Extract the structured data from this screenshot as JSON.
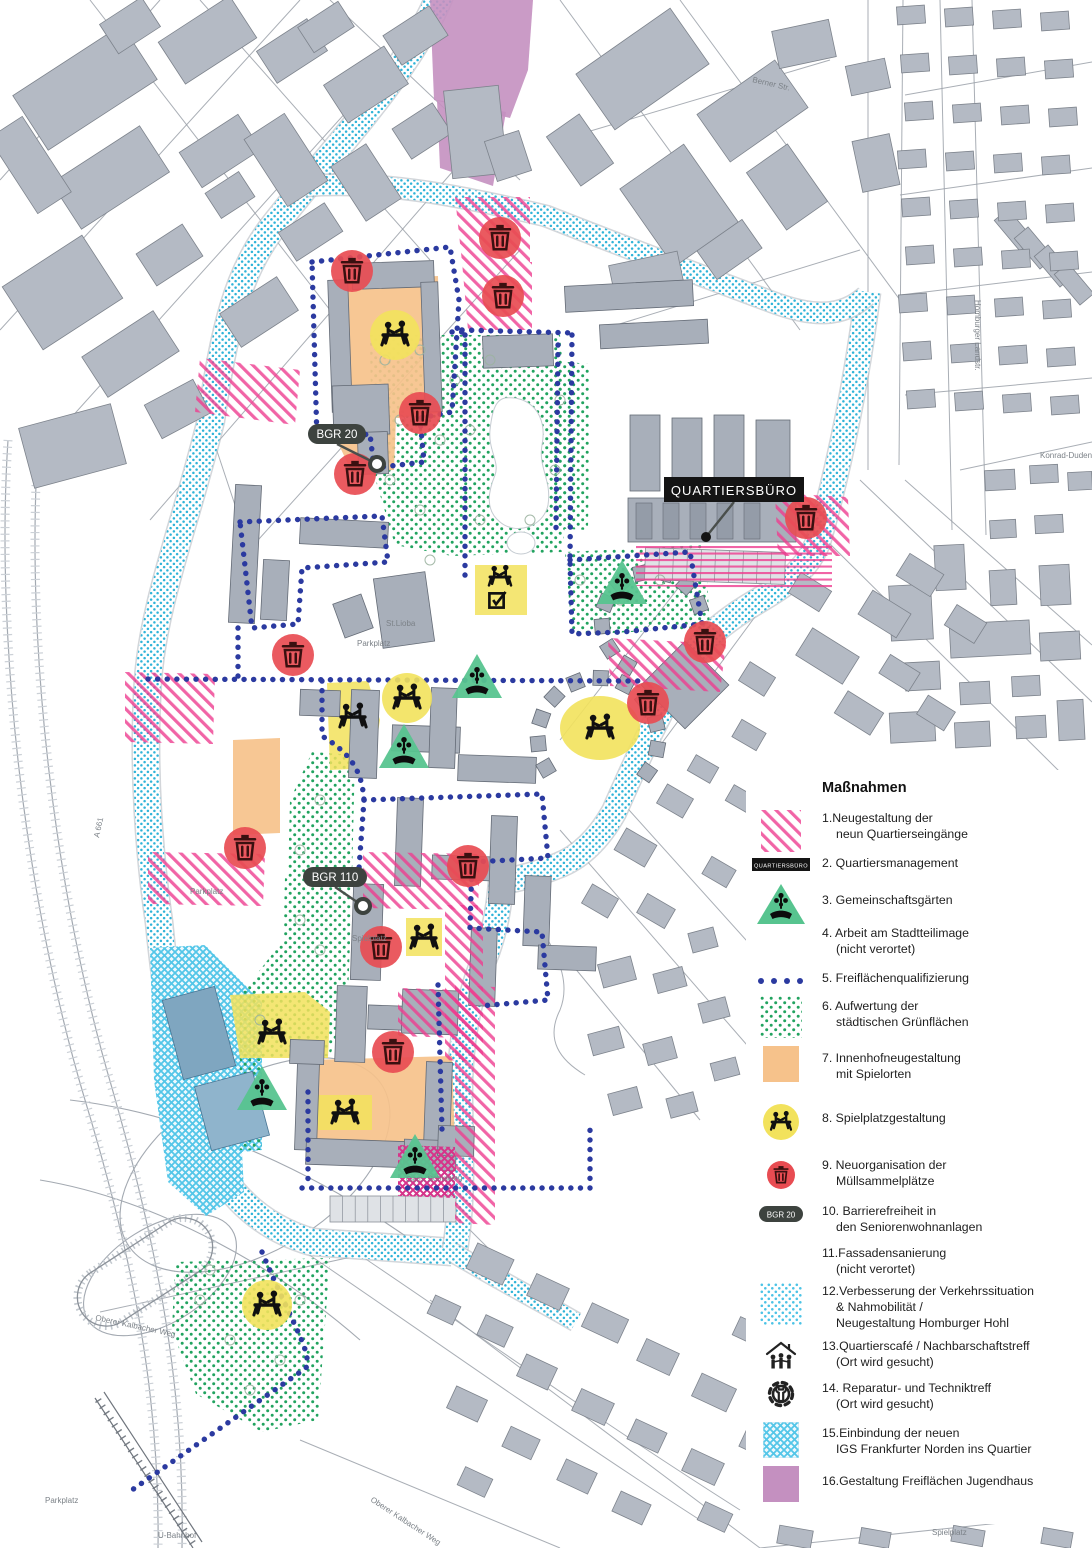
{
  "legend": {
    "title": "Maßnahmen",
    "items": [
      {
        "num": 1,
        "swatch": "pinkhatch",
        "lines": [
          "1.Neugestaltung der",
          "neun Quartierseingänge"
        ]
      },
      {
        "num": 2,
        "swatch": "qbtag",
        "swatch_text": "QUARTIERSBÜRO",
        "lines": [
          "2. Quartiersmanagement"
        ]
      },
      {
        "num": 3,
        "swatch": "garden",
        "lines": [
          "3. Gemeinschaftsgärten"
        ]
      },
      {
        "num": 4,
        "swatch": "none",
        "lines": [
          "4. Arbeit am Stadtteilimage",
          "(nicht verortet)"
        ]
      },
      {
        "num": 5,
        "swatch": "bluedots",
        "lines": [
          "5. Freiflächenqualifizierung"
        ]
      },
      {
        "num": 6,
        "swatch": "greendots",
        "lines": [
          "6. Aufwertung der",
          "städtischen Grünflächen"
        ]
      },
      {
        "num": 7,
        "swatch": "orange",
        "lines": [
          "7. Innenhofneugestaltung",
          "mit Spielorten"
        ]
      },
      {
        "num": 8,
        "swatch": "yellowplay",
        "lines": [
          "8. Spielplatzgestaltung"
        ]
      },
      {
        "num": 9,
        "swatch": "redtrash",
        "lines": [
          "9. Neuorganisation der",
          "Müllsammelplätze"
        ]
      },
      {
        "num": 10,
        "swatch": "bgrpill",
        "swatch_text": "BGR 20",
        "lines": [
          "10. Barrierefreiheit in",
          "den Seniorenwohnanlagen"
        ]
      },
      {
        "num": 11,
        "swatch": "none",
        "lines": [
          "11.Fassadensanierung",
          "(nicht verortet)"
        ]
      },
      {
        "num": 12,
        "swatch": "cyandots",
        "lines": [
          "12.Verbesserung der Verkehrssituation",
          "& Nahmobilität /",
          "Neugestaltung Homburger Hohl"
        ]
      },
      {
        "num": 13,
        "swatch": "cafe",
        "lines": [
          "13.Quartierscafé / Nachbarschaftstreff",
          "(Ort wird gesucht)"
        ]
      },
      {
        "num": 14,
        "swatch": "repair",
        "lines": [
          "14. Reparatur- und Techniktreff",
          "(Ort wird gesucht)"
        ]
      },
      {
        "num": 15,
        "swatch": "tealcross",
        "lines": [
          "15.Einbindung der neuen",
          "IGS Frankfurter Norden ins Quartier"
        ]
      },
      {
        "num": 16,
        "swatch": "purple",
        "lines": [
          "16.Gestaltung Freiflächen Jugendhaus"
        ]
      }
    ]
  },
  "map": {
    "callouts": [
      {
        "id": "quartiersbuero",
        "label": "QUARTIERSBÜRO",
        "box": [
          664,
          477,
          140,
          25
        ],
        "anchor": [
          706,
          537
        ],
        "style": "rect"
      },
      {
        "id": "bgr20",
        "label": "BGR 20",
        "box": [
          308,
          424,
          58,
          20
        ],
        "anchor": [
          377,
          464
        ],
        "style": "pill"
      },
      {
        "id": "bgr110",
        "label": "BGR 110",
        "box": [
          303,
          867,
          64,
          20
        ],
        "anchor": [
          363,
          906
        ],
        "style": "pill"
      }
    ],
    "street_labels": [
      {
        "text": "Berner Str.",
        "x": 752,
        "y": 82,
        "rot": 13
      },
      {
        "text": "Homburger Landstr.",
        "x": 975,
        "y": 300,
        "rot": 90
      },
      {
        "text": "Konrad-Duden-Weg",
        "x": 1040,
        "y": 458,
        "rot": 0
      },
      {
        "text": "A 661",
        "x": 99,
        "y": 838,
        "rot": -78
      },
      {
        "text": "Parkplatz",
        "x": 357,
        "y": 646,
        "rot": 0
      },
      {
        "text": "Parkplatz",
        "x": 190,
        "y": 894,
        "rot": 0
      },
      {
        "text": "Parkplatz",
        "x": 45,
        "y": 1503,
        "rot": 0
      },
      {
        "text": "St.Lioba",
        "x": 386,
        "y": 626,
        "rot": 0
      },
      {
        "text": "Spielplatz",
        "x": 352,
        "y": 941,
        "rot": 0
      },
      {
        "text": "Gem. Schulweg",
        "x": 406,
        "y": 1182,
        "rot": -2
      },
      {
        "text": "Oberer Kalbacher Weg",
        "x": 95,
        "y": 1320,
        "rot": 12
      },
      {
        "text": "Oberer Kalbacher Weg",
        "x": 370,
        "y": 1501,
        "rot": 33
      },
      {
        "text": "U-Bahnhof",
        "x": 158,
        "y": 1538,
        "rot": 0
      },
      {
        "text": "Spielplatz",
        "x": 932,
        "y": 1535,
        "rot": 0
      }
    ],
    "markers": {
      "trash": [
        [
          352,
          271
        ],
        [
          500,
          238
        ],
        [
          503,
          296
        ],
        [
          420,
          413
        ],
        [
          355,
          474
        ],
        [
          806,
          518
        ],
        [
          293,
          655
        ],
        [
          705,
          642
        ],
        [
          648,
          703
        ],
        [
          245,
          848
        ],
        [
          468,
          866
        ],
        [
          381,
          947
        ],
        [
          393,
          1052
        ]
      ],
      "garden": [
        [
          622,
          586
        ],
        [
          477,
          680
        ],
        [
          404,
          750
        ],
        [
          262,
          1092
        ],
        [
          415,
          1160
        ]
      ],
      "playground_circles": [
        [
          395,
          335
        ],
        [
          407,
          698
        ],
        [
          600,
          728
        ],
        [
          267,
          1305
        ]
      ],
      "playground_icons": [
        [
          395,
          335
        ],
        [
          407,
          698
        ],
        [
          600,
          728
        ],
        [
          267,
          1305
        ],
        [
          424,
          938
        ],
        [
          345,
          1113
        ],
        [
          272,
          1033
        ],
        [
          353,
          717
        ]
      ],
      "playground_check": [
        [
          500,
          583
        ]
      ]
    },
    "colors": {
      "pink": "#ee3d90",
      "blue_dots": "#2b3aa0",
      "green_dots": "#21a35f",
      "cyan": "#2fb3d8",
      "orange": "#f6c28b",
      "yellow": "#f2e25c",
      "red": "#e84c52",
      "green_triangle": "#57c48f",
      "purple": "#c490c0",
      "teal_light": "#e6f6fb",
      "building": "#b2b8c2",
      "tag_dark": "#3d433f"
    }
  }
}
